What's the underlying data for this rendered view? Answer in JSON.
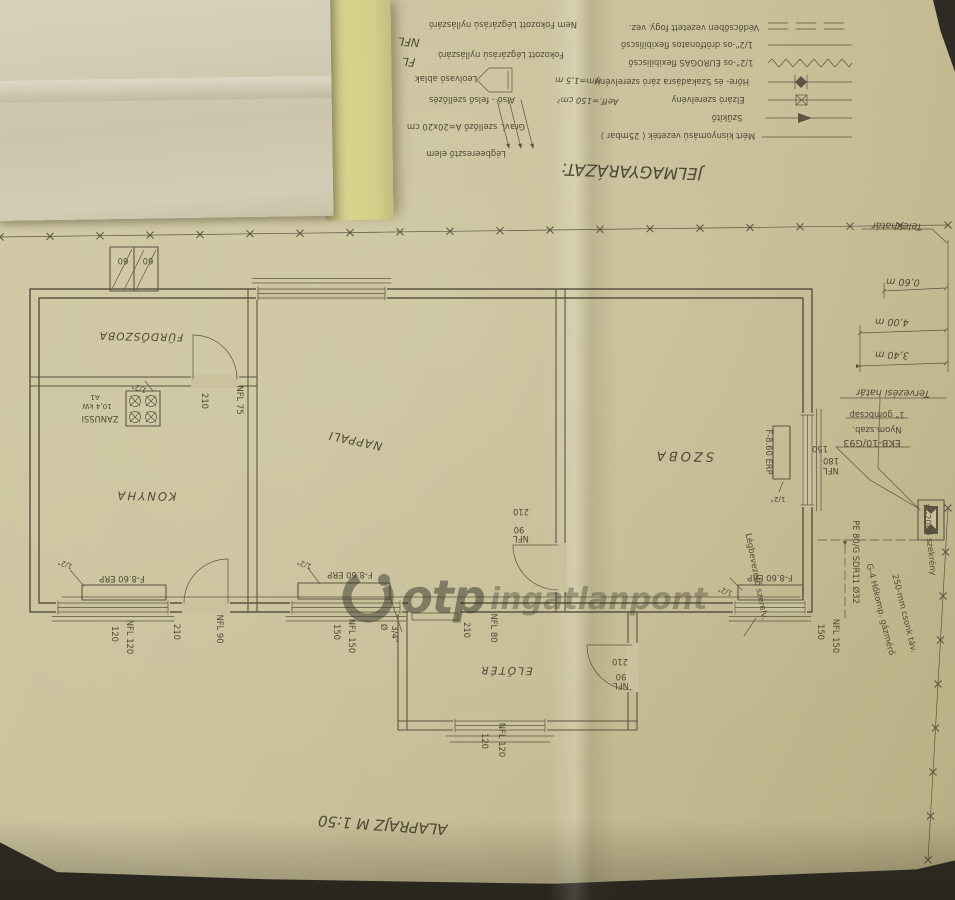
{
  "legend": {
    "title": "JELMAGYARÁZAT:",
    "line_items": [
      {
        "label": "Mért kisnyomású vezeték ( 25mbar )"
      },
      {
        "label": "Szűkítő"
      },
      {
        "label": "Elzáró szerelvény"
      },
      {
        "label": "Hőre- és Szakadásra záró szerelvény"
      },
      {
        "label": "1/2\"-os EUROGAS flexibiliscső"
      },
      {
        "label": "1/2\"-os drótfonatos flexibiliscső"
      },
      {
        "label": "Védőcsőben vezetett fogy. vez."
      }
    ],
    "opening_items": [
      {
        "code": "NFL",
        "label": "Nem Fokozott Légzárású nyílászáró"
      },
      {
        "code": "FL",
        "label": "Fokozott Légzárású nyílászáró"
      }
    ],
    "vent_items": [
      {
        "label": "Leolvasó ablak",
        "value": "Hm=1,5 m"
      },
      {
        "label": "Alsó - felső szellőzés",
        "value": "Aeff.=150 cm²"
      },
      {
        "label": "Gravi. szellőző A=20x20 cm",
        "value": ""
      },
      {
        "label": "Légbeeresztő elem",
        "value": ""
      }
    ]
  },
  "rooms": {
    "bathroom": "FÜRDŐSZOBA",
    "kitchen": "KONYHA",
    "living": "NAPPALI",
    "bedroom": "SZOBA",
    "hall": "ELŐTÉR"
  },
  "stove": {
    "brand": "ZANUSSI",
    "power": "10,4 kW",
    "code": "A1"
  },
  "equipment": {
    "convector": "F-8.60 ERP",
    "tap": "1/2\"",
    "branch_dia": "Ø",
    "branch_size": "3/4\""
  },
  "dims": {
    "d60": "60",
    "d75": "NFL 75",
    "d80": "NFL 80",
    "d90": "90",
    "d120": "120",
    "d150": "150",
    "d180": "180",
    "d210": "210",
    "nfl": "NFL",
    "nfl90": "NFL 90",
    "nfl120": "NFL 120",
    "nfl150": "NFL 150"
  },
  "site": {
    "plot_boundary": "Telekhatár",
    "design_boundary": "Tervezési határ",
    "dist_1": "0,60 m",
    "dist_2": "4,00 m",
    "dist_3": "3,40 m"
  },
  "service": {
    "valve": "1\" gombcsap",
    "pressure_reg": "Nyom.szab.",
    "regulator": "EKB-10/G93",
    "pipe": "PE 80/G SDR11 Ø32",
    "meter": "G-4 Hőkomp. gázmérő",
    "meter_note": "250-mm csonk táv.",
    "cabinet": "Ff-2008 szekrény",
    "air_inlet": "Légbevezető szerelv."
  },
  "title_block": {
    "scale": "ALAPRAJZ M 1:50"
  },
  "watermark": {
    "brand": "otp",
    "suffix": "ingatlanpont"
  }
}
